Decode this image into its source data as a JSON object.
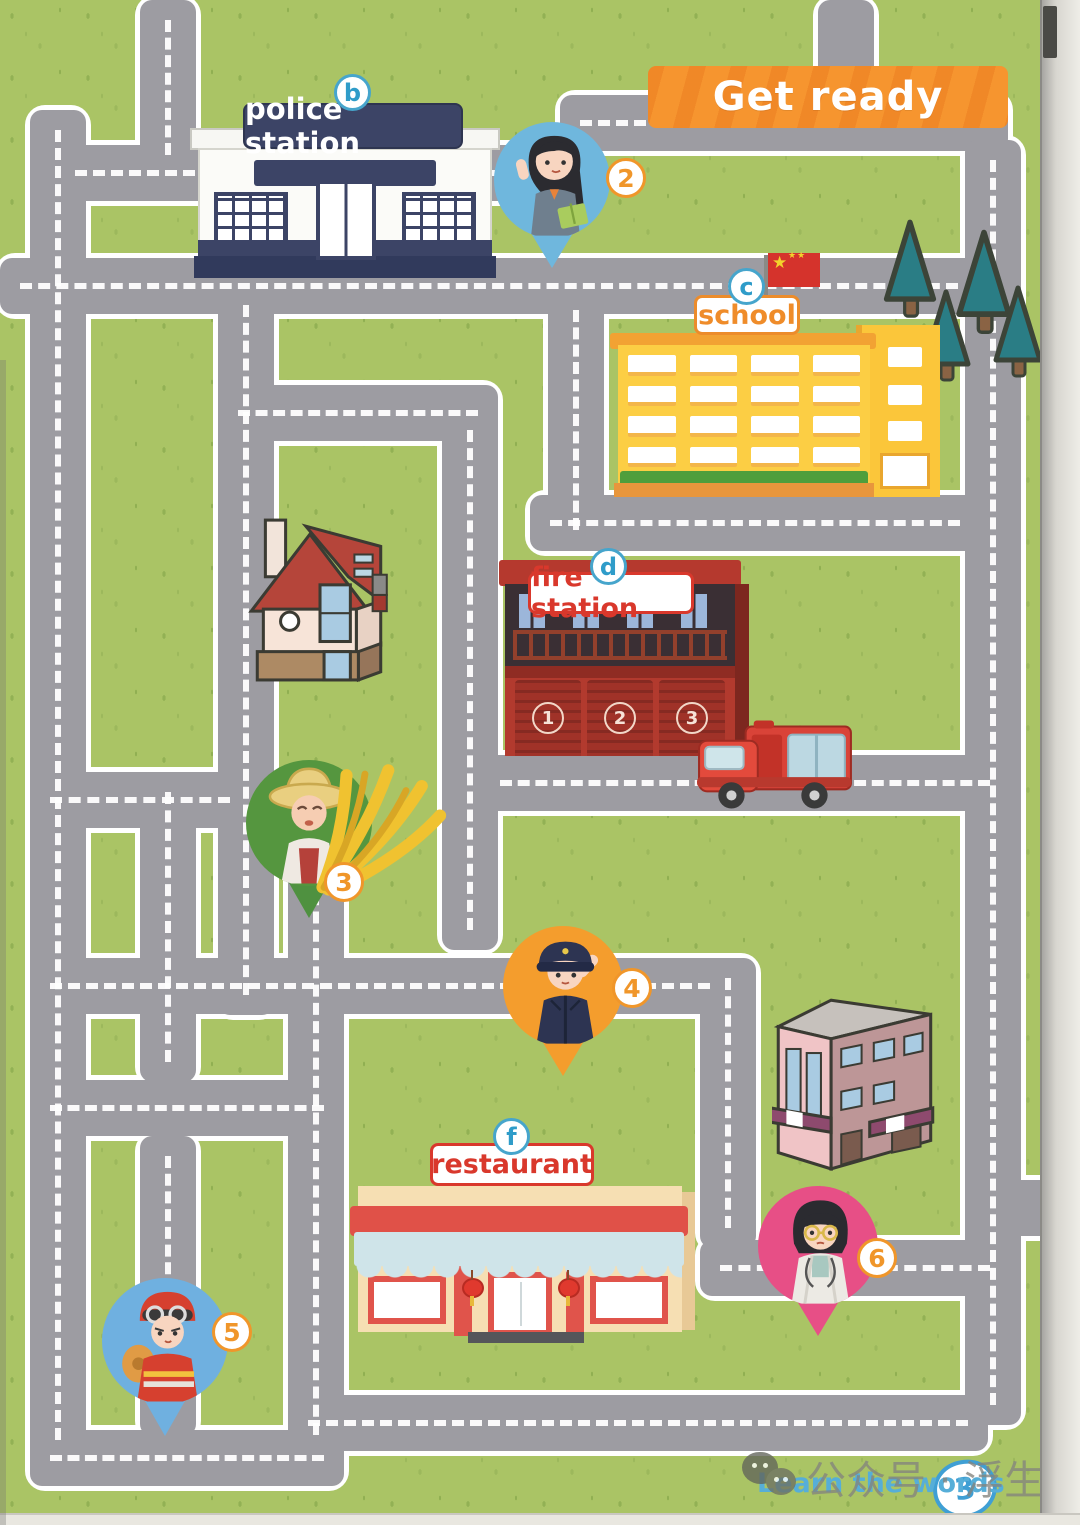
{
  "page": {
    "header_banner": "Get ready",
    "footer_link": "Learn the words",
    "page_number": "3",
    "watermark": "公众号 · 浮生英语"
  },
  "locations": [
    {
      "letter": "b",
      "label": "police station"
    },
    {
      "letter": "c",
      "label": "school"
    },
    {
      "letter": "d",
      "label": "fire station"
    },
    {
      "letter": "f",
      "label": "restaurant"
    }
  ],
  "people": [
    {
      "number": "2",
      "role": "teacher"
    },
    {
      "number": "3",
      "role": "farmer"
    },
    {
      "number": "4",
      "role": "police officer"
    },
    {
      "number": "5",
      "role": "firefighter"
    },
    {
      "number": "6",
      "role": "doctor"
    }
  ],
  "fire_station_doors": [
    "1",
    "2",
    "3"
  ],
  "icons": {
    "flag_star": "★",
    "wechat_icon": "wechat-bubbles",
    "location_pin": "map-pin"
  },
  "colors": {
    "grass_green": "#aac465",
    "road_gray": "#9d9ca2",
    "banner_orange": "#f6952f",
    "badge_letter_blue": "#46a5cc",
    "badge_number_orange": "#f0962a",
    "police_navy": "#3c4466",
    "school_yellow": "#fcce44",
    "school_trim_orange": "#f2a233",
    "fire_red": "#b5392e",
    "restaurant_red": "#e05148",
    "pin_teacher": "#6fb7dd",
    "pin_farmer": "#4f9140",
    "pin_police": "#f49d2d",
    "pin_firefighter": "#6fb0e0",
    "pin_doctor": "#e74f86",
    "footer_blue": "#56aed8",
    "flag_red": "#d5332c"
  }
}
